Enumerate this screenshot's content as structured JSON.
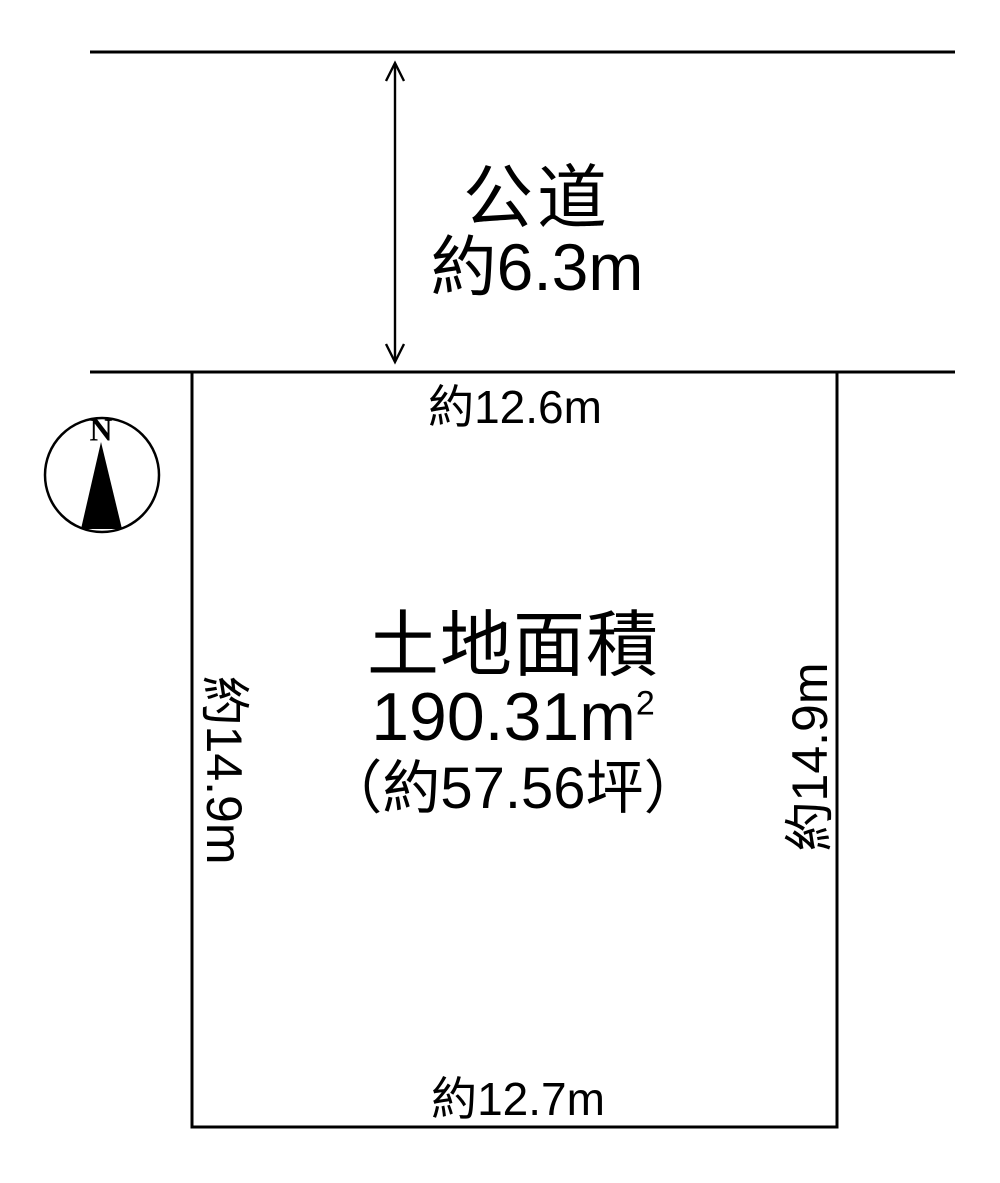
{
  "road": {
    "name": "公道",
    "width_label": "約6.3m"
  },
  "compass": {
    "north_label": "N"
  },
  "plot": {
    "area_title": "土地面積",
    "area_sqm": "190.31m",
    "area_sqm_sup": "2",
    "area_tsubo": "（約57.56坪）",
    "dim_top": "約12.6m",
    "dim_bottom": "約12.7m",
    "dim_left": "約14.9m",
    "dim_right": "約14.9m"
  },
  "colors": {
    "ink": "#000000",
    "background": "#ffffff"
  }
}
